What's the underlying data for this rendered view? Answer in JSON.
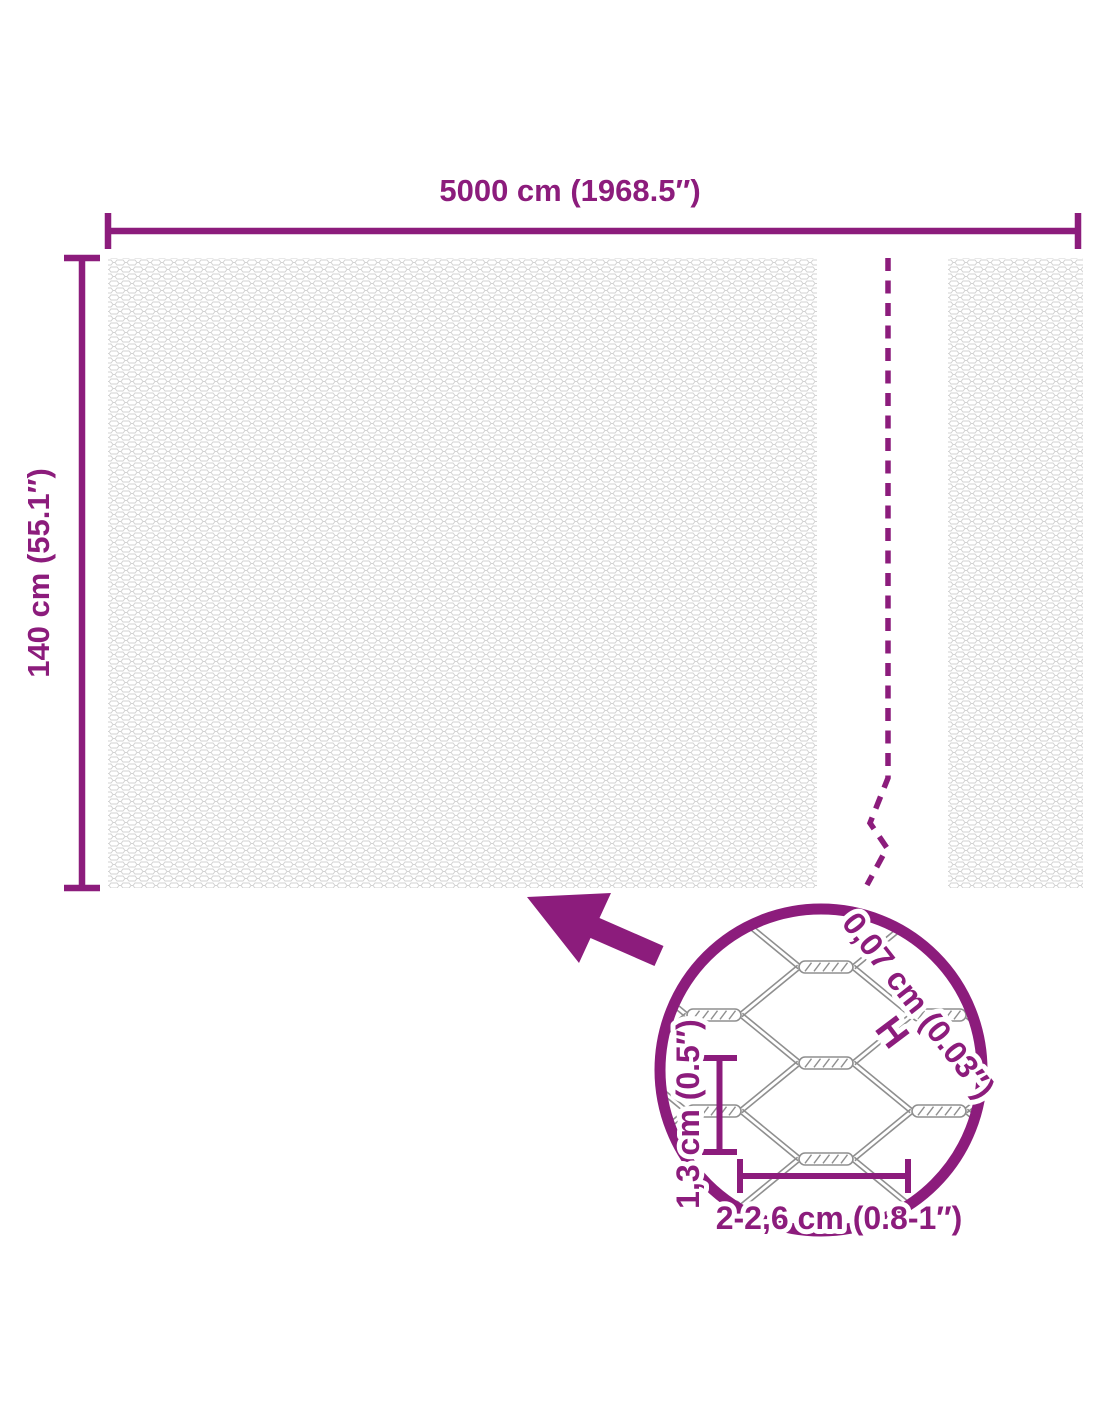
{
  "diagram": {
    "accent_color": "#8C1C7C",
    "mesh_texture_color": "#d2d2d2",
    "detail_wire_color": "#8f8f8f",
    "roll": {
      "width_label": "5000 cm (1968.5″)",
      "height_label": "140 cm (55.1″)"
    },
    "detail": {
      "wire_thickness_label": "0,07 cm (0.03″)",
      "wire_thickness_symbol": "H",
      "mesh_height_label": "1,3 cm (0.5″)",
      "mesh_width_label": "2-2,6 cm (0.8-1″)"
    }
  }
}
